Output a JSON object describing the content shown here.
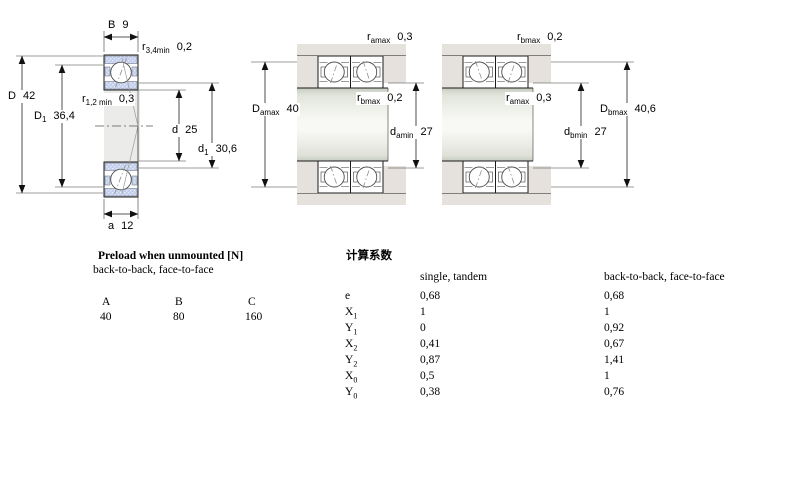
{
  "colors": {
    "page_bg": "#ffffff",
    "text": "#000000",
    "line": "#1b1b1b",
    "dim_line": "#222222",
    "contact_line": "#8f8f8f",
    "ring_fill": "#c3cfec",
    "ring_dot": "#e4eaf7",
    "housing_fill": "#e9e1de",
    "housing_dot": "#dbe3d8",
    "bore_fill": "#ebece9",
    "shaft_edge": "#c7ccc0",
    "shaft_mid": "#f8f9f5"
  },
  "left_view": {
    "B": {
      "base": "B",
      "value": "9"
    },
    "r34": {
      "base": "r",
      "sub": "3,4min",
      "value": "0,2"
    },
    "D": {
      "base": "D",
      "value": "42"
    },
    "D1": {
      "base": "D",
      "sub": "1",
      "value": "36,4"
    },
    "r12": {
      "base": "r",
      "sub": "1,2 min",
      "value": "0,3"
    },
    "d": {
      "base": "d",
      "value": "25"
    },
    "d1": {
      "base": "d",
      "sub": "1",
      "value": "30,6"
    },
    "a": {
      "base": "a",
      "value": "12"
    }
  },
  "middle_view": {
    "ramax": {
      "base": "r",
      "sub": "amax",
      "value": "0,3"
    },
    "rbmax": {
      "base": "r",
      "sub": "bmax",
      "value": "0,2"
    },
    "Damax": {
      "base": "D",
      "sub": "amax",
      "value": "40"
    },
    "damin": {
      "base": "d",
      "sub": "amin",
      "value": "27"
    }
  },
  "right_view": {
    "rbmax": {
      "base": "r",
      "sub": "bmax",
      "value": "0,2"
    },
    "ramax": {
      "base": "r",
      "sub": "amax",
      "value": "0,3"
    },
    "Dbmax": {
      "base": "D",
      "sub": "bmax",
      "value": "40,6"
    },
    "dbmin": {
      "base": "d",
      "sub": "bmin",
      "value": "27"
    }
  },
  "preload": {
    "title": "Preload when unmounted [N]",
    "subtitle": "back-to-back, face-to-face",
    "columns": [
      "A",
      "B",
      "C"
    ],
    "values": [
      "40",
      "80",
      "160"
    ]
  },
  "factors": {
    "title": "计算系数",
    "col1_header": "single, tandem",
    "col2_header": "back-to-back, face-to-face",
    "rows": [
      {
        "base": "e",
        "sub": "",
        "single_tandem": "0,68",
        "back_face": "0,68"
      },
      {
        "base": "X",
        "sub": "1",
        "single_tandem": "1",
        "back_face": "1"
      },
      {
        "base": "Y",
        "sub": "1",
        "single_tandem": "0",
        "back_face": "0,92"
      },
      {
        "base": "X",
        "sub": "2",
        "single_tandem": "0,41",
        "back_face": "0,67"
      },
      {
        "base": "Y",
        "sub": "2",
        "single_tandem": "0,87",
        "back_face": "1,41"
      },
      {
        "base": "X",
        "sub": "0",
        "single_tandem": "0,5",
        "back_face": "1"
      },
      {
        "base": "Y",
        "sub": "0",
        "single_tandem": "0,38",
        "back_face": "0,76"
      }
    ]
  }
}
